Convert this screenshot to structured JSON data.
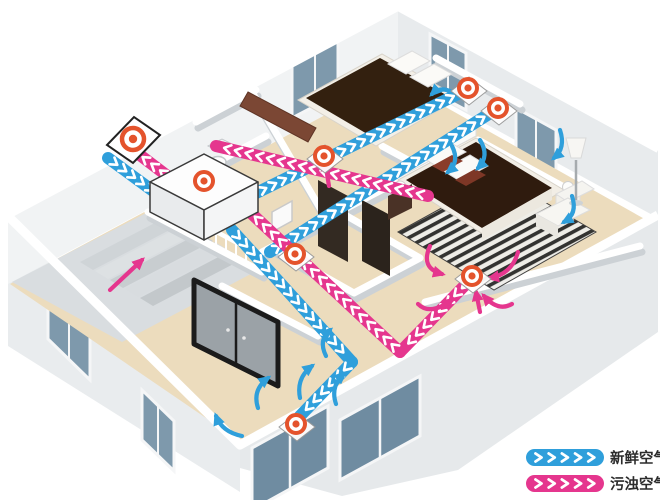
{
  "legend": {
    "items": [
      {
        "name": "fresh-air",
        "label": "新鲜空气",
        "color": "#2f9fdb"
      },
      {
        "name": "polluted-air",
        "label": "污浊空气",
        "color": "#e5368e"
      }
    ]
  },
  "colors": {
    "fresh": "#2f9fdb",
    "polluted": "#e5368e",
    "vent_ring": "#e4532c",
    "chevron": "#ffffff"
  },
  "diagram": {
    "unit": {
      "name": "ventilation-unit",
      "x": 204,
      "y": 181
    },
    "vents": [
      {
        "name": "outdoor-wall-vent",
        "type": "outdoor",
        "x": 133,
        "y": 139
      },
      {
        "name": "unit-top-vent",
        "type": "unit",
        "x": 204,
        "y": 181
      },
      {
        "name": "ceiling-diffuser-1",
        "type": "supply",
        "x": 468,
        "y": 88
      },
      {
        "name": "ceiling-diffuser-2",
        "type": "supply",
        "x": 498,
        "y": 108
      },
      {
        "name": "exhaust-vent-bedroom-2",
        "type": "exhaust",
        "x": 324,
        "y": 156
      },
      {
        "name": "exhaust-vent-hall",
        "type": "exhaust",
        "x": 295,
        "y": 254
      },
      {
        "name": "exhaust-vent-master",
        "type": "exhaust",
        "x": 472,
        "y": 276
      },
      {
        "name": "floor-vent-living",
        "type": "supply",
        "x": 296,
        "y": 424
      }
    ],
    "ducts": {
      "fresh": [
        [
          108,
          158,
          160,
          196
        ],
        [
          232,
          230,
          352,
          362
        ],
        [
          352,
          362,
          300,
          416
        ],
        [
          246,
          198,
          462,
          92
        ],
        [
          270,
          252,
          492,
          112
        ]
      ],
      "polluted": [
        [
          428,
          196,
          216,
          146
        ],
        [
          470,
          280,
          400,
          352
        ],
        [
          400,
          352,
          252,
          214
        ],
        [
          178,
          184,
          128,
          146
        ]
      ]
    },
    "room_arrows": {
      "fresh": [
        "M 258,408 Q 252,390 268,378",
        "M 300,398 Q 296,378 312,366",
        "M 336,404 Q 330,386 344,374",
        "M 242,436 Q 222,432 216,416",
        "M 452,146 Q 460,162 448,172",
        "M 480,140 Q 490,156 478,168",
        "M 560,130 Q 566,148 554,158",
        "M 572,196 Q 578,214 564,222",
        "M 452,92 Q 440,86 432,94",
        "M 326,356 Q 318,340 330,330"
      ],
      "polluted": [
        "M 430,246 Q 420,268 442,274",
        "M 518,252 Q 512,274 490,278",
        "M 512,304 Q 498,312 484,296",
        "M 418,304 Q 430,316 452,300",
        "M 480,312 L 476,292",
        "M 329,186 L 325,162",
        "M 110,290 L 142,260"
      ]
    }
  }
}
